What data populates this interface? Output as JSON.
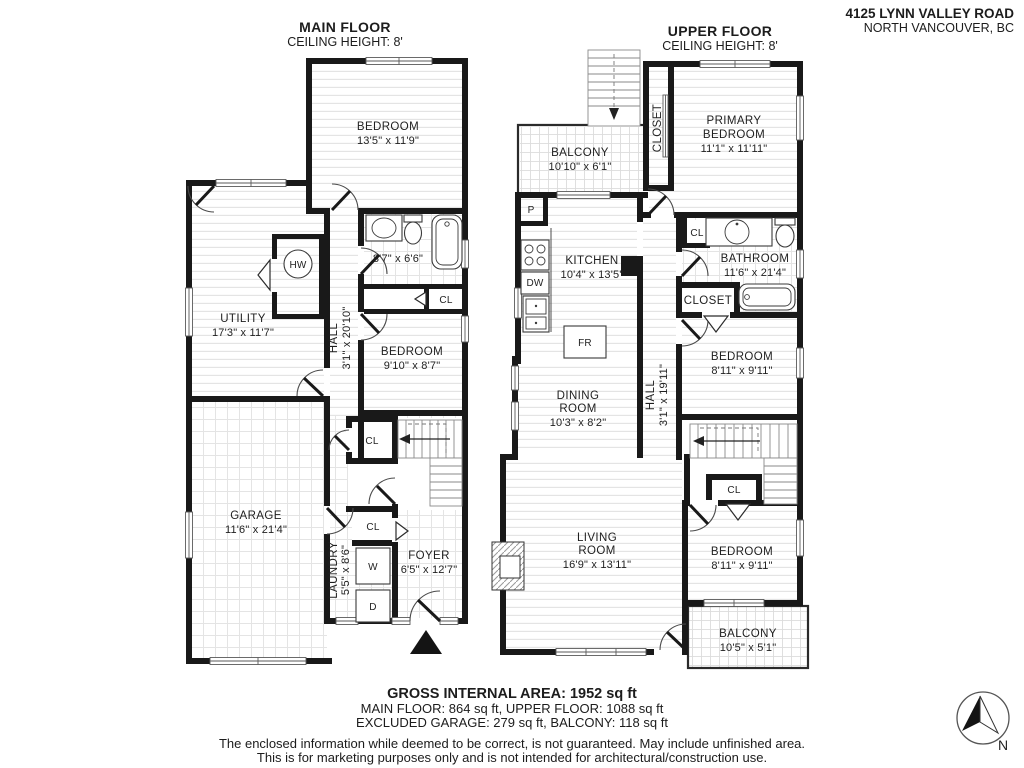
{
  "address": {
    "line1": "4125 LYNN VALLEY ROAD",
    "line2": "NORTH VANCOUVER, BC"
  },
  "floors": {
    "main": {
      "title": "MAIN FLOOR",
      "ceiling": "CEILING HEIGHT: 8'"
    },
    "upper": {
      "title": "UPPER FLOOR",
      "ceiling": "CEILING HEIGHT: 8'"
    }
  },
  "rooms": {
    "main_bedroom_top": {
      "name": "BEDROOM",
      "dims": "13'5\" x 11'9\""
    },
    "utility": {
      "name": "UTILITY",
      "dims": "17'3\" x 11'7\""
    },
    "main_bath": {
      "dims": "8'7\" x 6'6\""
    },
    "hall_main": {
      "name": "HALL",
      "dims": "3'1\" x 20'10\""
    },
    "main_bedroom_mid": {
      "name": "BEDROOM",
      "dims": "9'10\" x 8'7\""
    },
    "garage": {
      "name": "GARAGE",
      "dims": "11'6\" x 21'4\""
    },
    "laundry": {
      "name": "LAUNDRY",
      "dims": "5'5\" x 8'6\""
    },
    "foyer": {
      "name": "FOYER",
      "dims": "6'5\" x 12'7\""
    },
    "balcony_upper": {
      "name": "BALCONY",
      "dims": "10'10\" x 6'1\""
    },
    "primary": {
      "name1": "PRIMARY",
      "name2": "BEDROOM",
      "dims": "11'1\" x 11'11\""
    },
    "kitchen": {
      "name": "KITCHEN",
      "dims": "10'4\" x 13'5\""
    },
    "bathroom_upper": {
      "name": "BATHROOM",
      "dims": "11'6\" x 21'4\""
    },
    "hall_upper": {
      "name": "HALL",
      "dims": "3'1\" x 19'11\""
    },
    "bedroom_upper_mid": {
      "name": "BEDROOM",
      "dims": "8'11\" x 9'11\""
    },
    "dining": {
      "name1": "DINING",
      "name2": "ROOM",
      "dims": "10'3\" x 8'2\""
    },
    "living": {
      "name1": "LIVING",
      "name2": "ROOM",
      "dims": "16'9\" x 13'11\""
    },
    "bedroom_upper_bot": {
      "name": "BEDROOM",
      "dims": "8'11\" x 9'11\""
    },
    "balcony_lower": {
      "name": "BALCONY",
      "dims": "10'5\" x 5'1\""
    }
  },
  "fixtures": {
    "hot_water": "HW",
    "pantry": "P",
    "dishwasher": "DW",
    "fridge": "FR",
    "washer": "W",
    "dryer": "D",
    "closet_small": "CL",
    "closet": "CLOSET"
  },
  "compass": {
    "north": "N"
  },
  "footer": {
    "gross": "GROSS INTERNAL AREA: 1952 sq ft",
    "floors": "MAIN FLOOR: 864 sq ft, UPPER FLOOR: 1088 sq ft",
    "excluded": "EXCLUDED GARAGE: 279 sq ft, BALCONY: 118 sq ft",
    "disclaimer1": "The enclosed information while deemed to be correct, is not guaranteed. May include unfinished area.",
    "disclaimer2": "This is for marketing purposes only and is not intended for architectural/construction use."
  },
  "colors": {
    "wall": "#191919",
    "text": "#1f1f1f"
  }
}
